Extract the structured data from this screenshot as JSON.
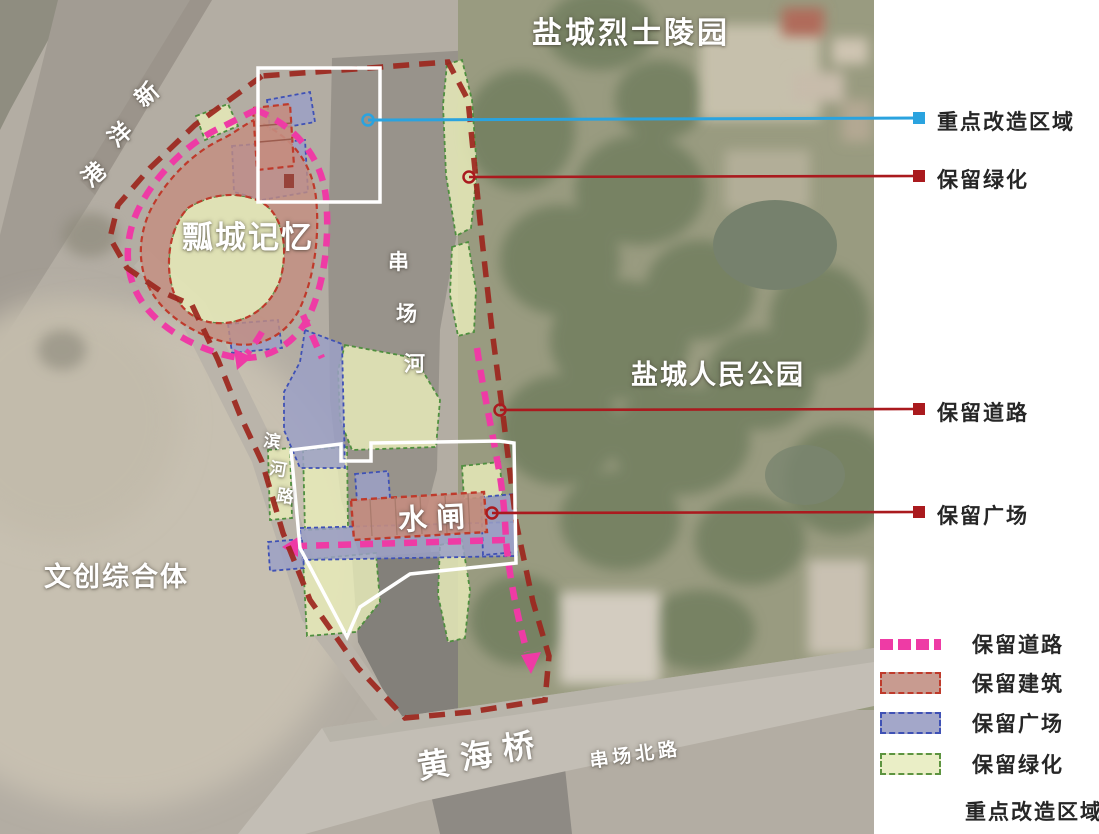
{
  "map": {
    "labels": {
      "martyrs_cemetery": "盐城烈士陵园",
      "xinyang_port": [
        "新",
        "洋",
        "港"
      ],
      "piaocheng_memory": "瓢城记忆",
      "chuanchang_river": [
        "串",
        "场",
        "河"
      ],
      "peoples_park": "盐城人民公园",
      "binhe_road": [
        "滨",
        "河",
        "路"
      ],
      "water_gate": "水闸",
      "cultural_complex": "文创综合体",
      "huanghai_bridge": [
        "黄",
        "海",
        "桥"
      ],
      "chuanchang_north_road": "串场北路"
    },
    "callouts": [
      {
        "id": "key-renovation-area",
        "label": "重点改造区域",
        "color": "#2aa3df"
      },
      {
        "id": "preserved-greenery",
        "label": "保留绿化",
        "color": "#aa1a1e"
      },
      {
        "id": "preserved-road",
        "label": "保留道路",
        "color": "#aa1a1e"
      },
      {
        "id": "preserved-plaza",
        "label": "保留广场",
        "color": "#aa1a1e"
      }
    ]
  },
  "legend": {
    "items": [
      {
        "id": "preserved-road",
        "label": "保留道路",
        "swatch": "dashed-line",
        "color": "#ee3ba5"
      },
      {
        "id": "preserved-building",
        "label": "保留建筑",
        "swatch": "area",
        "fill": "#c89b90",
        "border": "#bf3a2b"
      },
      {
        "id": "preserved-plaza",
        "label": "保留广场",
        "swatch": "area",
        "fill": "#a3a7c9",
        "border": "#3f51b5"
      },
      {
        "id": "preserved-greenery",
        "label": "保留绿化",
        "swatch": "area",
        "fill": "#eaeec6",
        "border": "#5d9440"
      },
      {
        "id": "key-renovation-area",
        "label": "重点改造区域",
        "swatch": "none"
      }
    ]
  },
  "colors": {
    "preserved_road_pink": "#ee3ba5",
    "boundary_maroon": "#9c261d",
    "building_fill": "#c48d7f",
    "building_border": "#bf3a2b",
    "plaza_fill": "#9ba0c5",
    "plaza_border": "#3f51b5",
    "green_fill": "#e6eab8",
    "green_border": "#4f8f3f",
    "highlight_outline": "#ffffff",
    "callout_blue": "#2aa3df",
    "callout_red": "#aa1a1e"
  }
}
